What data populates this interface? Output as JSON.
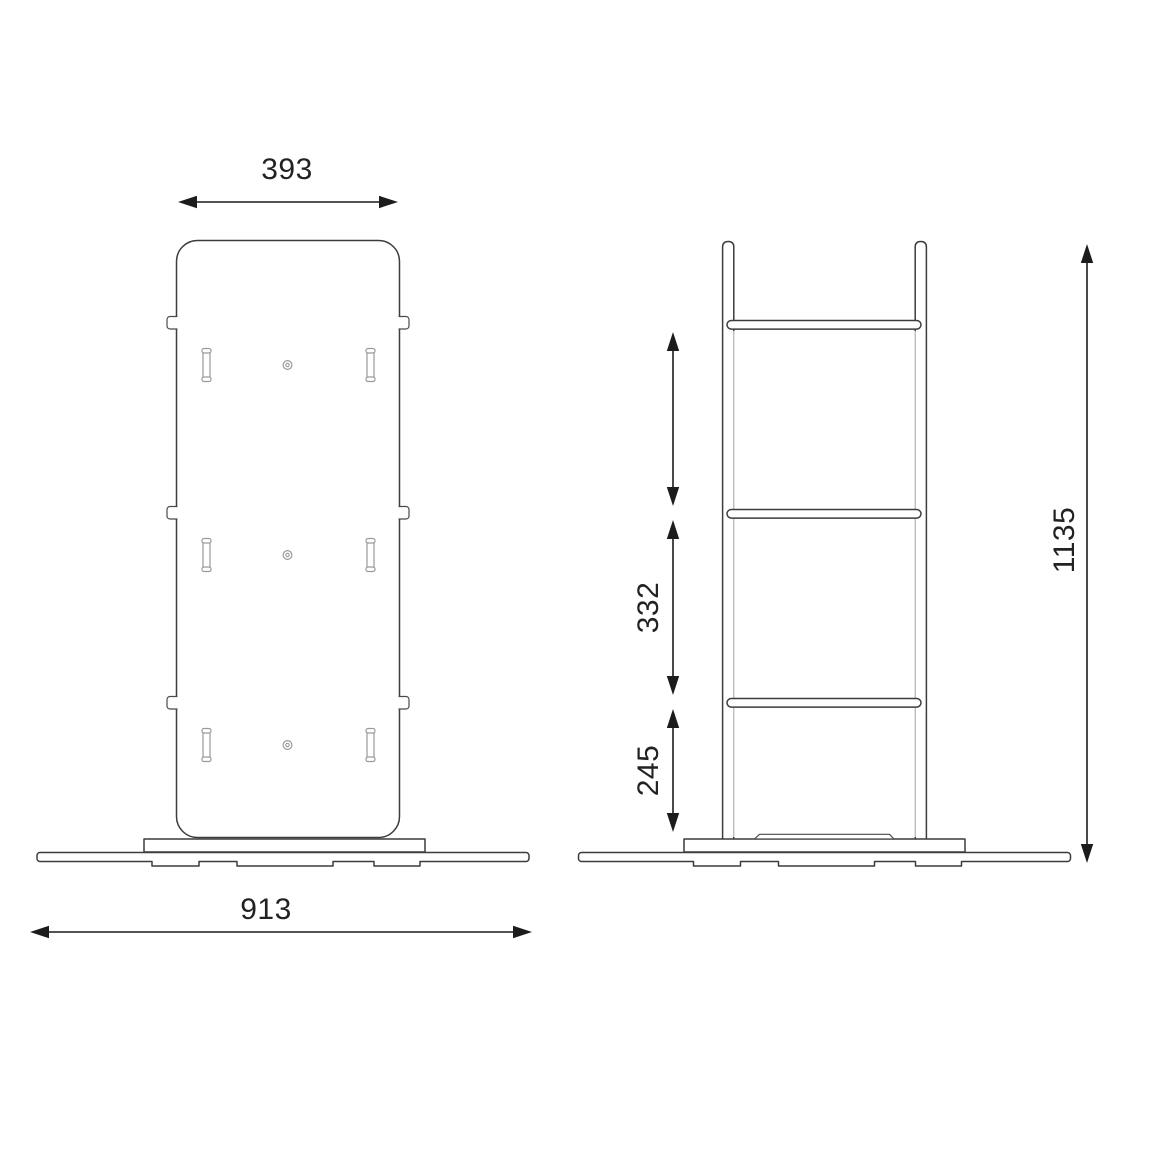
{
  "colors": {
    "background": "#ffffff",
    "outline_dark": "#3c3c3c",
    "outline_light": "#9a9a9a",
    "dimension": "#1c1c1c"
  },
  "dimensions": {
    "panel_width": "393",
    "base_width": "913",
    "shelf_spacing": "332",
    "base_to_first_shelf": "245",
    "overall_height": "1135"
  }
}
